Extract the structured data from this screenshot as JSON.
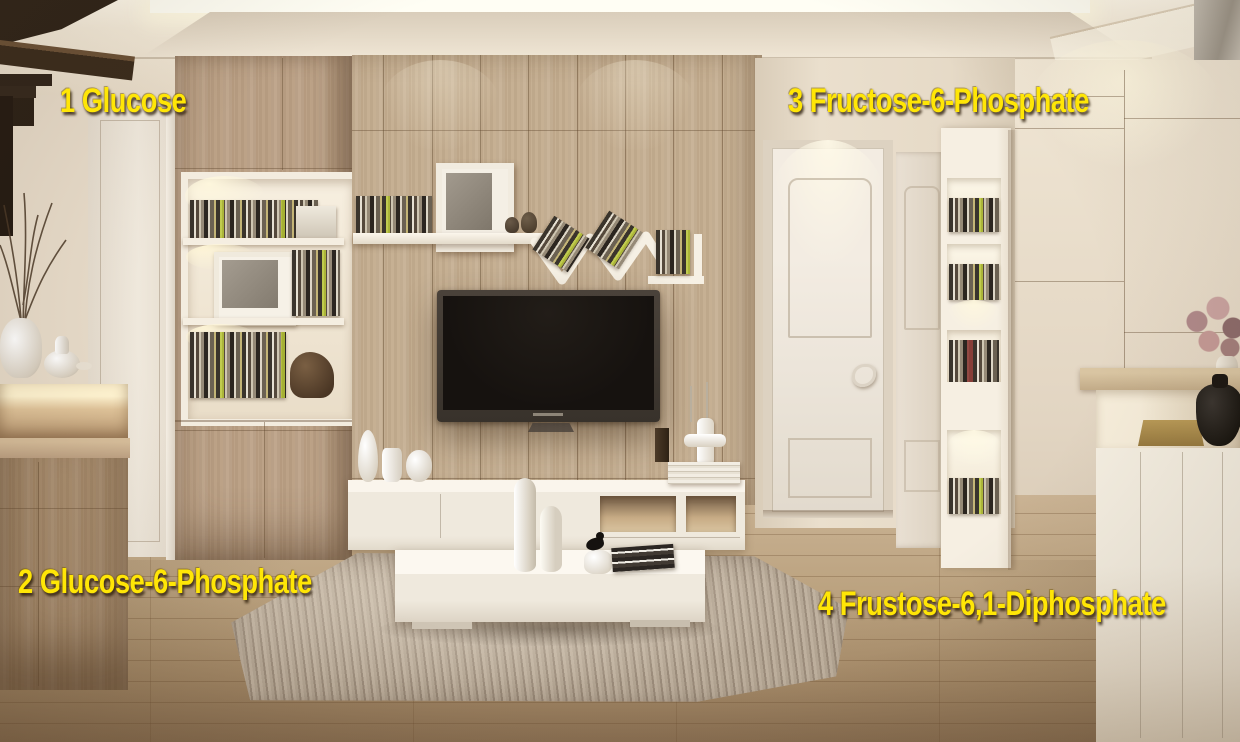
{
  "annotations": [
    {
      "id": "1",
      "text": "1 Glucose"
    },
    {
      "id": "2",
      "text": "2 Glucose-6-Phosphate"
    },
    {
      "id": "3",
      "text": "3 Fructose-6-Phosphate"
    },
    {
      "id": "4",
      "text": "4 Frustose-6,1-Diphosphate"
    }
  ],
  "colors": {
    "annotation_yellow": "#ffe606",
    "wood_wall": "#c3ac8e",
    "floor_wood": "#b89a76",
    "white_furniture": "#efe9dd",
    "rug_taupe": "#ab9e8d",
    "tv_screen": "#16120f",
    "ceiling_cream": "#f3ead9"
  }
}
